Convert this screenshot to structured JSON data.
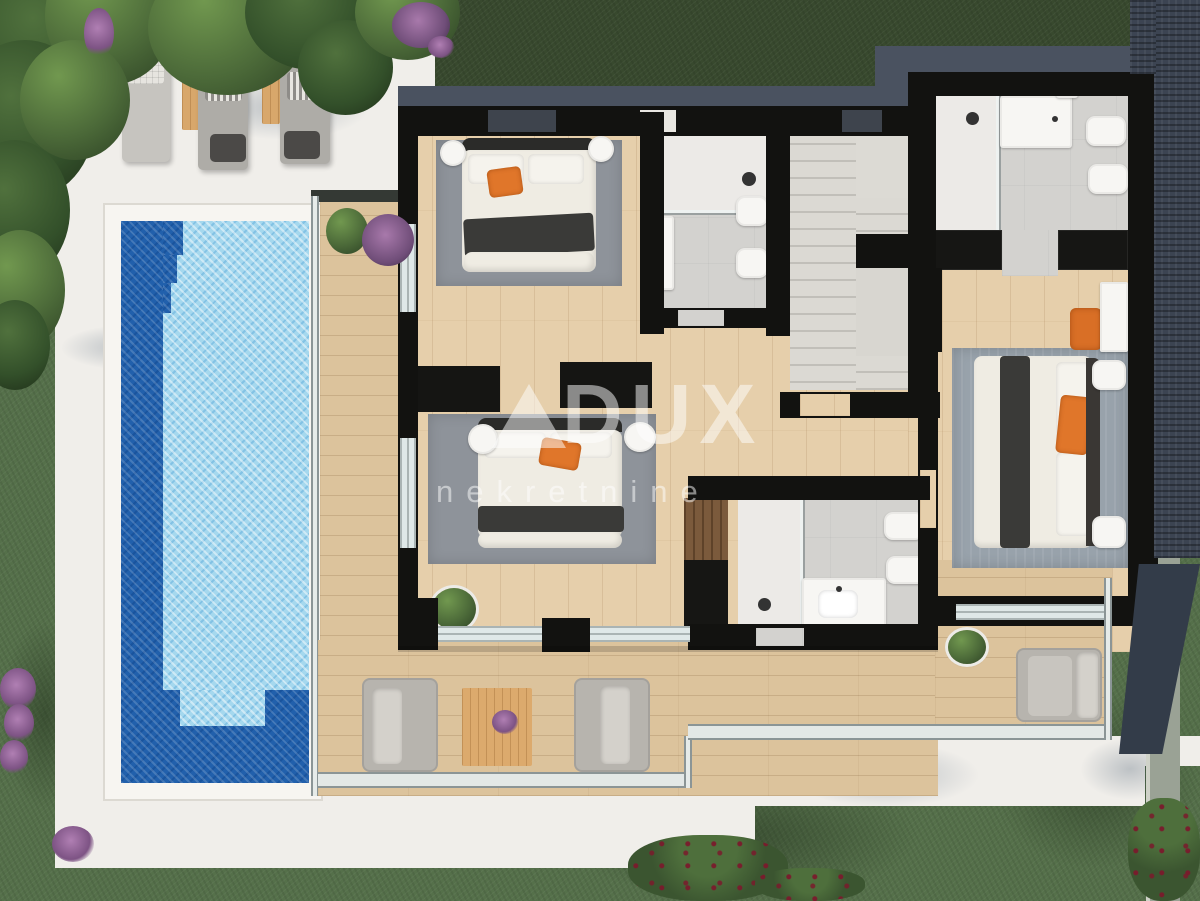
{
  "watermark": {
    "brand": "DUX",
    "tagline": "nekretnine",
    "logo": "mountain-triangle-logo",
    "text_color": "#ffffff"
  },
  "palette": {
    "lawn": "#55704a",
    "lawn_dark": "#38492e",
    "patio": "#f0eeea",
    "pool_rim": "#f7f5f1",
    "pool_water": "#a5d8ee",
    "pool_deep": "#2160ac",
    "wood_floor": "#e6cfab",
    "deck_wood": "#dcc39c",
    "wall": "#121210",
    "roof_slate": "#4a5260",
    "roof_dark": "#3c4452",
    "tile": "#d3d2cf",
    "shower": "#eceae7",
    "fixture": "#f7f6f3",
    "stair": "#d8d6d0",
    "rug": "#8e939a",
    "rug_blue": "#98a2ab",
    "linen": "#efece3",
    "throw": "#3a3a38",
    "accent_orange": "#e0762a",
    "sofa_gray": "#b7b4ae",
    "side_table_wood": "#d8a76b",
    "wm_color": "#ffffff"
  },
  "features": [
    "lawn",
    "pool-patio",
    "swimming-pool",
    "pool-steps",
    "sun-loungers",
    "hedge",
    "tree-canopy",
    "balcony",
    "bedroom-1",
    "bedroom-2",
    "bedroom-3",
    "bathroom-1",
    "bathroom-2",
    "bathroom-3",
    "staircase",
    "wardrobes",
    "terrace-seating",
    "glass-railing",
    "flat-roof",
    "garden-path"
  ]
}
